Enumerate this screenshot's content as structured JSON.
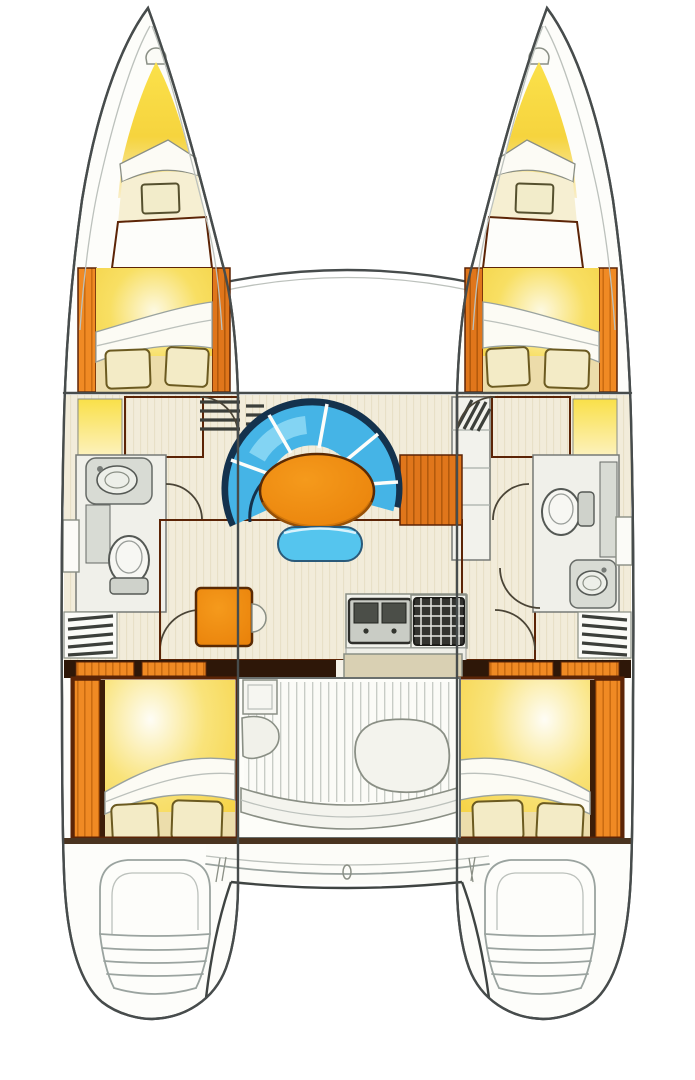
{
  "diagram": {
    "type": "catamaran-floor-plan",
    "view": "top-down interior layout drawing, no text labels",
    "hulls": 2,
    "layout": {
      "bow": "two pointed bows with anchor notch, forepeak lockers and V-berth foredecks; curved forward crossbeam between hulls",
      "port_hull": [
        "forepeak",
        "forward-double-berth",
        "head-with-sink-and-toilet",
        "companionway-steps",
        "aft-double-berth",
        "transom-steps"
      ],
      "starboard_hull": [
        "forepeak",
        "forward-double-berth",
        "head-with-toilet-and-sink",
        "companionway-steps",
        "aft-double-berth",
        "transom-steps"
      ],
      "bridgedeck": [
        "salon-curved-settee",
        "oval-table",
        "small-bench",
        "chart-table-with-seat",
        "galley-double-sink",
        "galley-stove",
        "cockpit-with-benches",
        "aft-beam"
      ]
    },
    "counts": {
      "double_berths": 4,
      "pillows": 8,
      "toilets": 2,
      "sinks_head": 2,
      "galley_sink_basins": 2,
      "settee_cushion_segments": 5,
      "transom_step_flights": 2
    }
  },
  "colors": {
    "wood": "#e0761b",
    "wood_line": "#b35a0c",
    "wood_bright": "#f08a24",
    "wood_bright_line": "#c96a10",
    "wood_dark_frame": "#5c2406",
    "dark_band": "#2e1708",
    "cream": "#f2ecda",
    "cream_line": "#e7dfc5",
    "berth_yellow": "#f6d340",
    "berth_glow": "#fdf9e2",
    "berth_base": "#ecdcaa",
    "pillow": "#f3ebc6",
    "pillow_edge": "#6b5a20",
    "sheet_white": "#fcfbf4",
    "cushion_blue": "#45b4e6",
    "cushion_blue_light": "#8ed9f4",
    "navy": "#14324d",
    "table_orange": "#ef8c12",
    "table_edge": "#5a2a04",
    "bath_floor": "#f0f0ea",
    "fixture_gray": "#d8dbd4",
    "fixture_white": "#f7f7f3",
    "sink_dark": "#4b4e48",
    "stove_dark": "#33332f",
    "counter_white": "#f2f2ec",
    "teak_white": "#fbfbf7",
    "teak_line": "#c6cac4",
    "hull_white": "#fdfdfa",
    "beige_door": "#d9d0b3",
    "shelf_yellow": "#f9e049"
  }
}
